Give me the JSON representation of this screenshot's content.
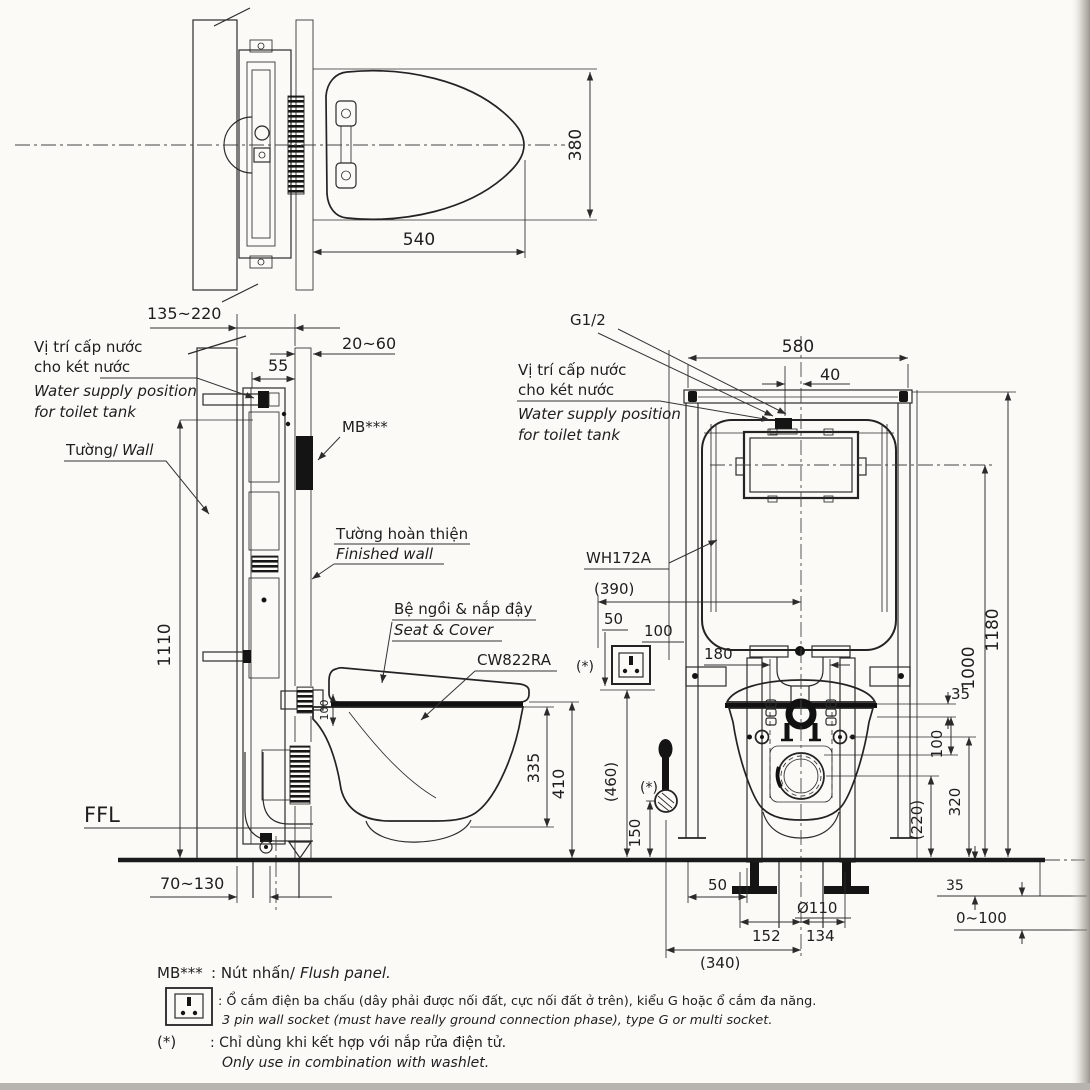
{
  "colors": {
    "line": "#2b2b2b",
    "paper": "#fbfaf7",
    "dark": "#141414"
  },
  "plan": {
    "dim_depth": "540",
    "dim_width": "380"
  },
  "side": {
    "dim_wall_range": "135~220",
    "dim_finish_range": "20~60",
    "dim_55": "55",
    "dim_height": "1110",
    "dim_inlet": "100",
    "dim_335": "335",
    "dim_410": "410",
    "dim_outlet_range": "70~130",
    "supply_vi1": "Vị trí cấp nước",
    "supply_vi2": "cho két nước",
    "supply_en1": "Water supply position",
    "supply_en2": "for toilet tank",
    "wall_vi": "Tường/",
    "wall_en": "Wall",
    "mb": "MB***",
    "finwall_vi": "Tường hoàn thiện",
    "finwall_en": "Finished wall",
    "seat_vi": "Bệ ngồi & nắp đậy",
    "seat_en": "Seat & Cover",
    "bowl_model": "CW822RA",
    "ffl": "FFL"
  },
  "front": {
    "g_thread": "G1/2",
    "tank_model": "WH172A",
    "star": "(*)",
    "supply_vi1": "Vị trí cấp nước",
    "supply_vi2": "cho két nước",
    "supply_en1": "Water supply position",
    "supply_en2": "for toilet tank",
    "dim_580": "580",
    "dim_40": "40",
    "dim_1180": "1180",
    "dim_1000": "1000",
    "dim_35_rim": "35",
    "dim_100": "100",
    "dim_320": "320",
    "dim_220": "(220)",
    "dim_390": "(390)",
    "dim_50_socket": "50",
    "dim_100_socket": "100",
    "dim_460": "(460)",
    "dim_150": "150",
    "dim_180": "180",
    "dim_35_floor": "35",
    "dim_screed": "0~100",
    "dim_50_leg": "50",
    "dim_drain": "Ø110",
    "dim_152": "152",
    "dim_134": "134",
    "dim_340": "(340)"
  },
  "legend": {
    "mb_key": "MB***",
    "mb_vi": ": Nút nhấn/",
    "mb_en": "Flush panel.",
    "socket_vi": ": Ổ cắm điện ba chấu (dây phải được nối đất, cực nối đất ở trên), kiểu G hoặc ổ cắm đa năng.",
    "socket_en": "3 pin wall socket (must have really ground connection phase), type G or multi socket.",
    "star_key": "(*)",
    "star_vi": ": Chỉ dùng khi kết hợp với nắp rửa điện tử.",
    "star_en": "Only use in combination with washlet."
  }
}
